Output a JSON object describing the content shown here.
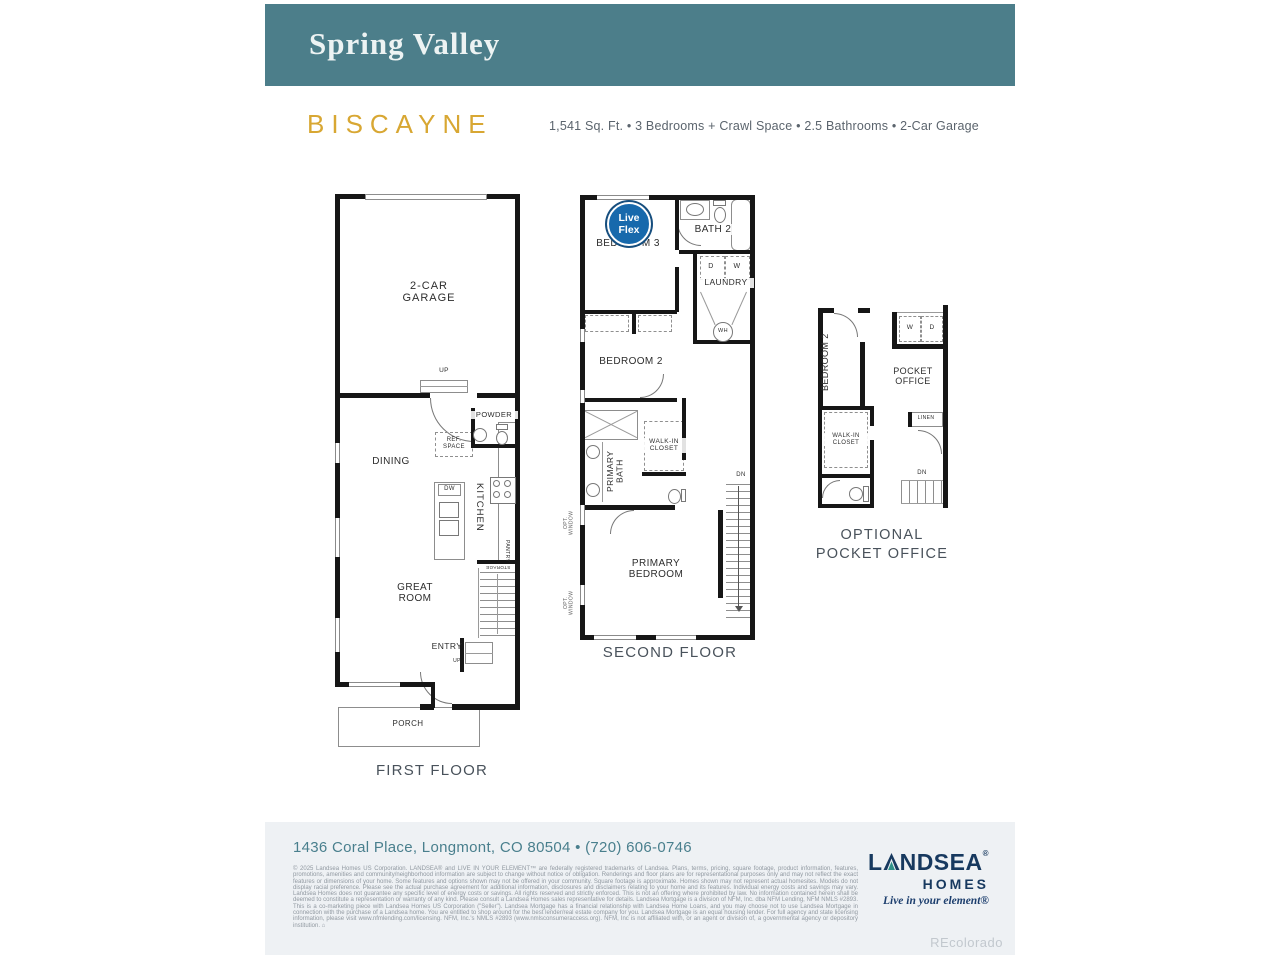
{
  "header": {
    "community": "Spring Valley"
  },
  "plan": {
    "name": "BISCAYNE",
    "specs": "1,541 Sq. Ft.  •  3 Bedrooms + Crawl Space  •  2.5 Bathrooms  •  2-Car Garage"
  },
  "colors": {
    "header_teal": "#4C7E8A",
    "plan_gold": "#D8A733",
    "logo_navy": "#17395F",
    "logo_teal": "#2F9188",
    "badge_blue": "#1769AC",
    "footer_bg": "#EEF1F4",
    "address_teal": "#497F8D"
  },
  "first_floor": {
    "caption": "FIRST FLOOR",
    "labels": {
      "garage": "2-CAR\nGARAGE",
      "up": "UP",
      "powder": "POWDER",
      "ref_space": "REF.\nSPACE",
      "dining": "DINING",
      "dw": "DW",
      "kitchen": "KITCHEN",
      "pantry": "PANTRY",
      "storage": "STORAGE",
      "great_room": "GREAT\nROOM",
      "entry": "ENTRY",
      "porch": "PORCH"
    }
  },
  "second_floor": {
    "caption": "SECOND FLOOR",
    "badge": "Live\nFlex",
    "labels": {
      "bedroom3": "BEDROOM 3",
      "bath2": "BATH 2",
      "d": "D",
      "w": "W",
      "laundry": "LAUNDRY",
      "wh": "WH",
      "bedroom2": "BEDROOM 2",
      "primary_bath": "PRIMARY\nBATH",
      "walk_in_closet": "WALK-IN\nCLOSET",
      "primary_bedroom": "PRIMARY\nBEDROOM",
      "dn": "DN",
      "opt_window": "OPT.\nWINDOW"
    }
  },
  "pocket_office": {
    "caption": "OPTIONAL\nPOCKET OFFICE",
    "labels": {
      "bedroom2": "BEDROOM 2",
      "w": "W",
      "d": "D",
      "pocket_office": "POCKET\nOFFICE",
      "linen": "LINEN",
      "walk_in_closet": "WALK-IN\nCLOSET",
      "dn": "DN"
    }
  },
  "footer": {
    "address": "1436 Coral Place, Longmont, CO 80504  •  (720) 606-0746",
    "legal": "© 2025 Landsea Homes US Corporation. LANDSEA® and LIVE IN YOUR ELEMENT™ are federally registered trademarks of Landsea. Plans, terms, pricing, square footage, product information, features, promotions, amenities and community/neighborhood information are subject to change without notice or obligation. Renderings and floor plans are for representational purposes only and may not reflect the exact features or dimensions of your home. Some features and options shown may not be offered in your community. Square footage is approximate. Homes shown may not represent actual homesites. Models do not display racial preference. Please see the actual purchase agreement for additional information, disclosures and disclaimers relating to your home and its features. Individual energy costs and savings may vary. Landsea Homes does not guarantee any specific level of energy costs or savings. All rights reserved and strictly enforced. This is not an offering where prohibited by law. No information contained herein shall be deemed to constitute a representation or warranty of any kind. Please consult a Landsea Homes sales representative for details. Landsea Mortgage is a division of NFM, Inc. dba NFM Lending, NFM NMLS #2893. This is a co-marketing piece with Landsea Homes US Corporation (\"Seller\"). Landsea Mortgage has a financial relationship with Landsea Home Loans, and you may choose not to use Landsea Mortgage in connection with the purchase of a Landsea home. You are entitled to shop around for the best lender/real estate company for you. Landsea Mortgage is an equal housing lender. For full agency and state licensing information, please visit www.nfmlending.com/licensing. NFM, Inc.'s NMLS #2893 (www.nmlsconsumeraccess.org). NFM, Inc is not affiliated with, or an agent or division of, a governmental agency or depository institution. ⌂",
    "logo": {
      "prefix": "L",
      "suffix": "NDSEA",
      "reg": "®",
      "homes": "HOMES",
      "tagline": "Live in your element®"
    },
    "watermark": "REcolorado"
  }
}
